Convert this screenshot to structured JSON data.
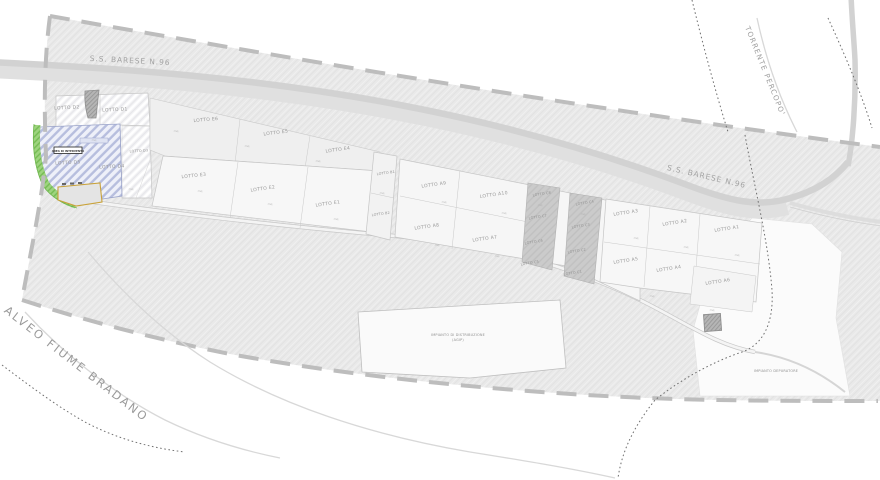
{
  "map": {
    "roads": {
      "ss96_a": "S.S. BARESE N.96",
      "ss96_b": "S.S. BARESE N.96"
    },
    "waterways": {
      "torrente": "TORRENTE PERCOPO'",
      "fiume": "ALVEO FIUME BRADANO"
    },
    "facilities": {
      "fuel_line1": "IMPIANTO DI DISTRIBUZIONE",
      "fuel_line2": "(AGIP)",
      "depuratore": "IMPIANTO DEPURATORE"
    },
    "highlight": {
      "box": "AREA DI INTERVENTO"
    },
    "area_mark": "mq",
    "lots": [
      {
        "label": "LOTTO D2"
      },
      {
        "label": "LOTTO D1"
      },
      {
        "label": "LOTTO D5"
      },
      {
        "label": "LOTTO D4"
      },
      {
        "label": "LOTTO D3"
      },
      {
        "label": "LOTTO E6"
      },
      {
        "label": "LOTTO E5"
      },
      {
        "label": "LOTTO E4"
      },
      {
        "label": "LOTTO E3"
      },
      {
        "label": "LOTTO E2"
      },
      {
        "label": "LOTTO E1"
      },
      {
        "label": "LOTTO B1"
      },
      {
        "label": "LOTTO B2"
      },
      {
        "label": "LOTTO A9"
      },
      {
        "label": "LOTTO A10"
      },
      {
        "label": "LOTTO A8"
      },
      {
        "label": "LOTTO A7"
      },
      {
        "label": "LOTTO C8"
      },
      {
        "label": "LOTTO C7"
      },
      {
        "label": "LOTTO C6"
      },
      {
        "label": "LOTTO C5"
      },
      {
        "label": "LOTTO C4"
      },
      {
        "label": "LOTTO C3"
      },
      {
        "label": "LOTTO C2"
      },
      {
        "label": "LOTTO C1"
      },
      {
        "label": "LOTTO A3"
      },
      {
        "label": "LOTTO A2"
      },
      {
        "label": "LOTTO A1"
      },
      {
        "label": "LOTTO A5"
      },
      {
        "label": "LOTTO A4"
      },
      {
        "label": "LOTTO A6"
      }
    ],
    "colors": {
      "zone_gray": "#eaeaea",
      "lot_white": "#f6f6f6",
      "lot_dark": "#c9c9c9",
      "highlight_blue": "#b7bede",
      "green_strip": "#86c96a",
      "yellow_outline": "#c9a23a",
      "boundary_dash": "#bdbdbd"
    }
  }
}
